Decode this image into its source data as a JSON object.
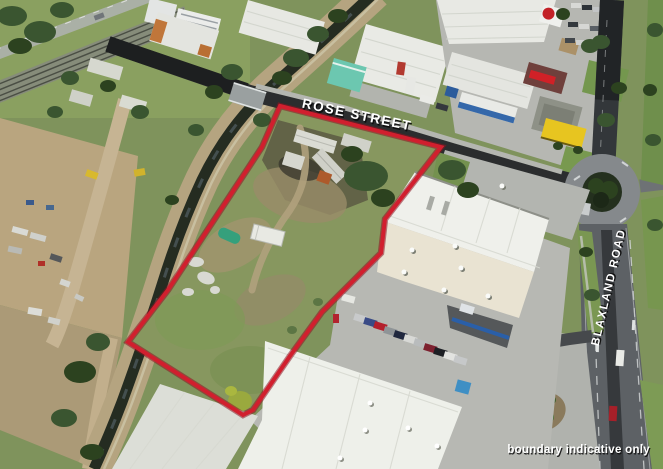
{
  "photo": {
    "description": "aerial property photograph",
    "labels": {
      "rose_street": "ROSE STREET",
      "blaxland_road": "BLAXLAND ROAD",
      "disclaimer": "boundary indicative only"
    },
    "colors": {
      "boundary_red": "#d11f2e",
      "boundary_red_dark": "#8c1420",
      "label_text": "#ffffff",
      "label_shadow": "#0a0a0a"
    },
    "boundary": {
      "points": "280,106 441,147 385,219 381,253 322,312 290,356 253,410 243,415 128,342 168,290 262,147"
    }
  }
}
